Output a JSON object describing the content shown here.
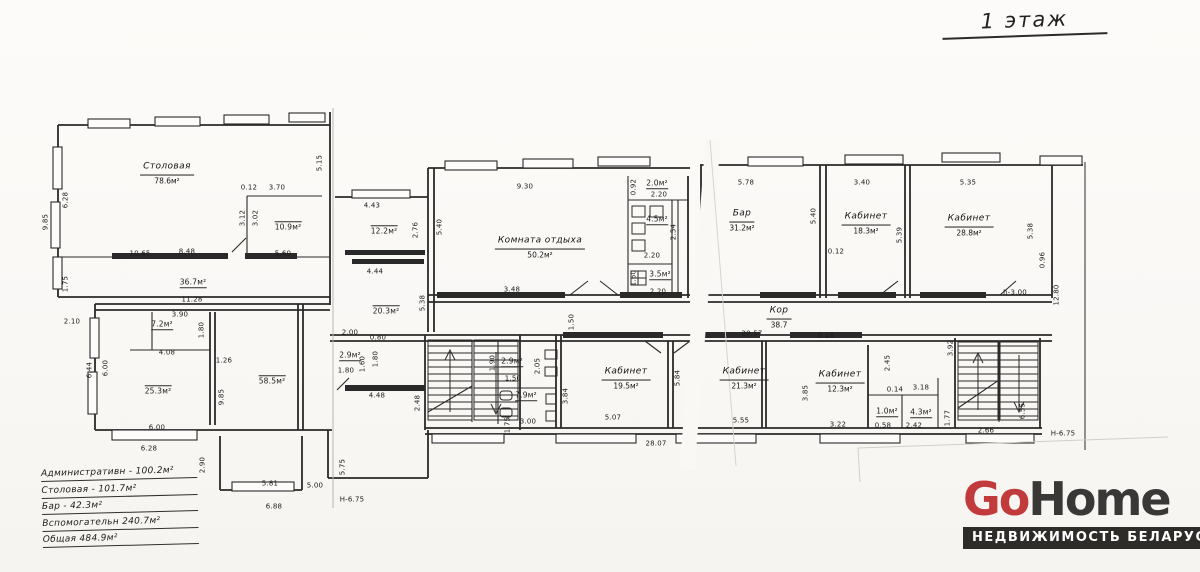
{
  "title": "1 этаж",
  "legend": {
    "rows": [
      "Административн - 100.2м²",
      "Столовая - 101.7м²",
      "Бар - 42.3м²",
      "Вспомогательн 240.7м²",
      "Общая 484.9м²"
    ]
  },
  "logo": {
    "go": "Go",
    "home": "Home",
    "tagline": "НЕДВИЖИМОСТЬ БЕЛАРУСИ"
  },
  "colors": {
    "accent_red": "#c13a3c",
    "logo_dark": "#3a3836",
    "line": "#2a2a2a"
  },
  "rooms": {
    "stolovaya": {
      "name": "Столовая",
      "area": "78.6м²"
    },
    "k_otdyha": {
      "name": "Комната отдыха",
      "area": "50.2м²"
    },
    "bar": {
      "name": "Бар",
      "area": "31.2м²"
    },
    "kab183": {
      "name": "Кабинет",
      "area": "18.3м²"
    },
    "kab288": {
      "name": "Кабинет",
      "area": "28.8м²"
    },
    "kab195": {
      "name": "Кабинет",
      "area": "19.5м²"
    },
    "kab213": {
      "name": "Кабинет",
      "area": "21.3м²"
    },
    "kab123": {
      "name": "Кабинет",
      "area": "12.3м²"
    },
    "kor": {
      "name": "Кор",
      "area": "38.7"
    }
  },
  "areas": {
    "a109": "10.9м²",
    "a122": "12.2м²",
    "a367": "36.7м²",
    "a203": "20.3м²",
    "a20": "2.0м²",
    "a45": "4.5м²",
    "a35": "3.5м²",
    "a72": "7.2м²",
    "a253": "25.3м²",
    "a585": "58.5м²",
    "a29a": "2.9м²",
    "a29b": "2.9м²",
    "a79": "7.9м²",
    "a10": "1.0м²",
    "a43": "4.3м²"
  },
  "dims": {
    "d985a": "9.85",
    "d628a": "6.28",
    "d175": "1.75",
    "d210": "2.10",
    "d644": "6.44",
    "d600a": "6.00",
    "d012a": "0.12",
    "d370": "3.70",
    "d312": "3.12",
    "d302": "3.02",
    "d1065": "10.65",
    "d848": "8.48",
    "d560": "5.60",
    "d515": "5.15",
    "d443": "4.43",
    "d276": "2.76",
    "d540a": "5.40",
    "d930": "9.30",
    "d444": "4.44",
    "d538a": "5.38",
    "d348": "3.48",
    "d150a": "1.50",
    "d092": "0.92",
    "d220a": "2.20",
    "d254": "2.54",
    "d220b": "2.20",
    "d160a": "1.60",
    "d220c": "2.20",
    "d578": "5.78",
    "d340": "3.40",
    "d535": "5.35",
    "d540b": "5.40",
    "d012b": "0.12",
    "d539": "5.39",
    "d538b": "5.38",
    "d096": "0.96",
    "h300": "h-3.00",
    "d1280": "12.80",
    "d2057": "20.57",
    "d018": "0.18",
    "d1128": "11.28",
    "d390": "3.90",
    "d180a": "1.80",
    "d408": "4.08",
    "d126": "1.26",
    "d985b": "9.85",
    "d600b": "6.00",
    "d628b": "6.28",
    "d290": "2.90",
    "d581": "5.81",
    "d500": "5.00",
    "d688": "6.88",
    "d575": "5.75",
    "h675a": "Н-6.75",
    "d200": "2.00",
    "d080": "0.80",
    "d160b": "1.60",
    "d180b": "1.80",
    "d180c": "1.80",
    "d448": "4.48",
    "d248": "2.48",
    "d190": "1.90",
    "d205": "2.05",
    "d150b": "1.50",
    "d175b": "1.75",
    "d300": "3.00",
    "d384": "3.84",
    "d584": "5.84",
    "d507": "5.07",
    "d2807": "28.07",
    "d385": "3.85",
    "d555": "5.55",
    "d322": "3.22",
    "d245": "2.45",
    "d014": "0.14",
    "d318": "3.18",
    "d058": "0.58",
    "d242": "2.42",
    "d177": "1.77",
    "d392": "3.92",
    "d655": "6.55",
    "d266": "2.66",
    "h675b": "Н-6.75"
  }
}
